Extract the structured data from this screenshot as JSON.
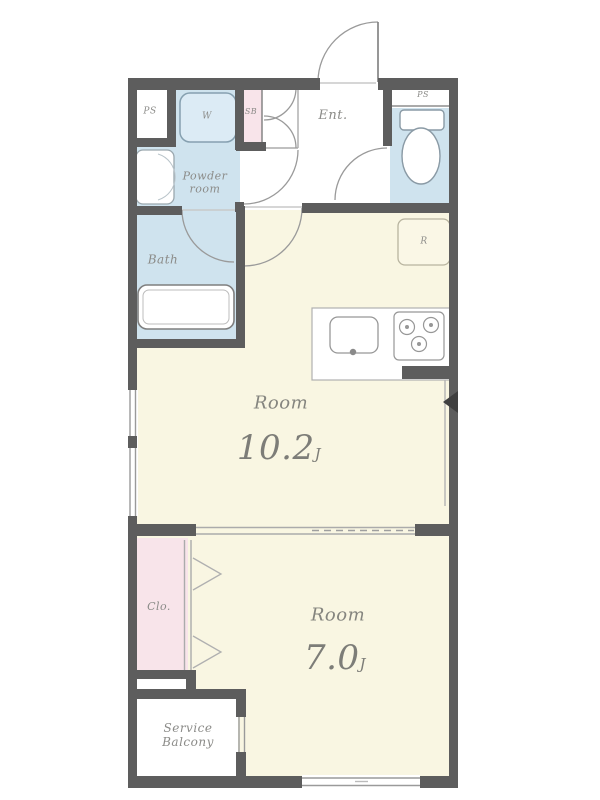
{
  "rooms": {
    "ps_left": {
      "label": "PS"
    },
    "washer": {
      "label": "W"
    },
    "shoe_box": {
      "label": "SB"
    },
    "entrance": {
      "label": "Ent."
    },
    "ps_right": {
      "label": "PS"
    },
    "powder": {
      "line1": "Powder",
      "line2": "room"
    },
    "bath": {
      "label": "Bath"
    },
    "refrigerator": {
      "label": "R"
    },
    "main_room": {
      "label": "Room",
      "size": "10.2",
      "unit": "J"
    },
    "closet": {
      "label": "Clo."
    },
    "second_room": {
      "label": "Room",
      "size": "7.0",
      "unit": "J"
    },
    "service_balcony": {
      "line1": "Service",
      "line2": "Balcony"
    }
  },
  "colors": {
    "wall": "#5d5d5d",
    "room_cream": "#f9f6e2",
    "wet_blue": "#cfe3ee",
    "accent_pink": "#f8e4ea",
    "fixture_white": "#ffffff",
    "label_gray": "#8b8b88"
  }
}
